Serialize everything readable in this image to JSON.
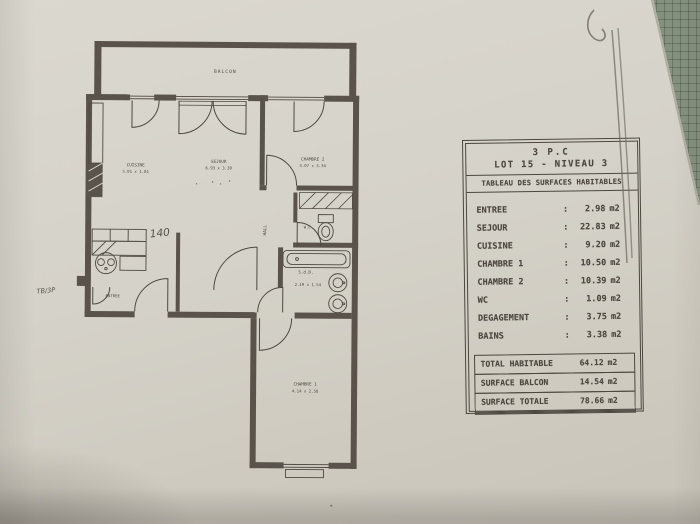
{
  "colors": {
    "paper": "#d4d0c6",
    "ink": "#4c473f",
    "wall": "#59534b",
    "pencil": "#6f6a62",
    "mat": "#85917f"
  },
  "plan": {
    "balcony_label": "BALCON",
    "rooms": {
      "cuisine": {
        "name": "CUISINE",
        "dims": "5.01 x 1.81"
      },
      "sejour": {
        "name": "SEJOUR",
        "dims": "6.93 x 3.30"
      },
      "chambre2": {
        "name": "CHAMBRE 2",
        "dims": "3.07 x 3.34"
      },
      "chambre1": {
        "name": "CHAMBRE 1",
        "dims": "4.14 x 2.58"
      },
      "sdb": {
        "name": "S.d.B.",
        "dims": "2.19 x 1.54"
      },
      "wc": {
        "name": "W.C"
      },
      "hall": {
        "name": "HALL"
      },
      "entree": {
        "name": "ENTREE"
      }
    },
    "handwritten": {
      "measure": "140",
      "reference": "TB/3P"
    }
  },
  "table": {
    "title_line1": "3 P.C",
    "title_line2": "LOT 15 - NIVEAU 3",
    "subtitle": "TABLEAU DES SURFACES HABITABLES",
    "colon": ":",
    "rows": [
      {
        "label": "ENTREE",
        "value": "2.98",
        "unit": "m2"
      },
      {
        "label": "SEJOUR",
        "value": "22.83",
        "unit": "m2"
      },
      {
        "label": "CUISINE",
        "value": "9.20",
        "unit": "m2"
      },
      {
        "label": "CHAMBRE 1",
        "value": "10.50",
        "unit": "m2"
      },
      {
        "label": "CHAMBRE 2",
        "value": "10.39",
        "unit": "m2"
      },
      {
        "label": "WC",
        "value": "1.09",
        "unit": "m2"
      },
      {
        "label": "DEGAGEMENT",
        "value": "3.75",
        "unit": "m2"
      },
      {
        "label": "BAINS",
        "value": "3.38",
        "unit": "m2"
      }
    ],
    "totals": [
      {
        "label": "TOTAL HABITABLE",
        "value": "64.12",
        "unit": "m2"
      },
      {
        "label": "SURFACE BALCON",
        "value": "14.54",
        "unit": "m2"
      },
      {
        "label": "SURFACE TOTALE",
        "value": "78.66",
        "unit": "m2"
      }
    ]
  }
}
